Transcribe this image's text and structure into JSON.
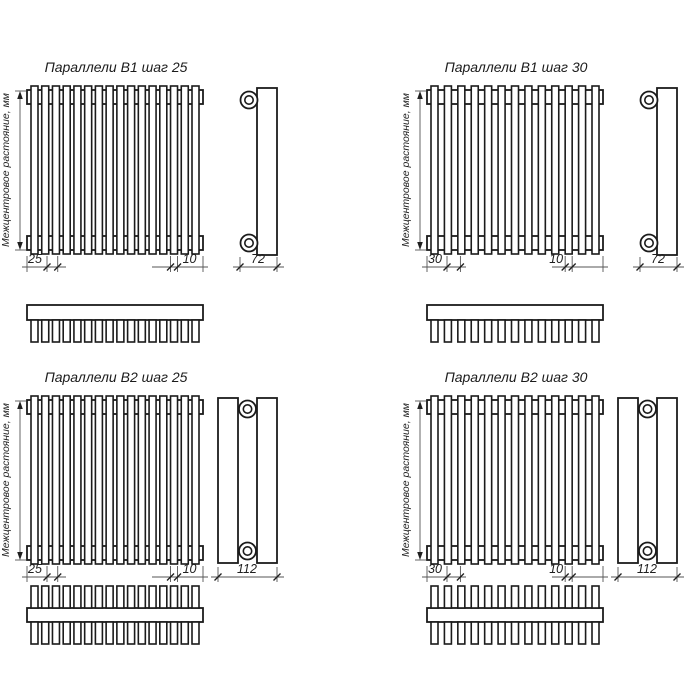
{
  "drawing": {
    "background": "#ffffff",
    "line_color": "#1b1b1b",
    "dim_color": "#555555",
    "text_color": "#1f1f1f",
    "diagrams": [
      {
        "id": "parallels-b1-step-25",
        "title": "Параллели В1 шаг 25",
        "rows": 1,
        "tube_count": 16,
        "step_label": "25",
        "tube_label": "10",
        "depth_label": "72",
        "axis_label": "Межцентровое растояние, мм"
      },
      {
        "id": "parallels-b1-step-30",
        "title": "Параллели В1 шаг 30",
        "rows": 1,
        "tube_count": 13,
        "step_label": "30",
        "tube_label": "10",
        "depth_label": "72",
        "axis_label": "Межцентровое растояние, мм"
      },
      {
        "id": "parallels-b2-step-25",
        "title": "Параллели В2 шаг 25",
        "rows": 2,
        "tube_count": 16,
        "step_label": "25",
        "tube_label": "10",
        "depth_label": "112",
        "axis_label": "Межцентровое растояние, мм"
      },
      {
        "id": "parallels-b2-step-30",
        "title": "Параллели В2 шаг 30",
        "rows": 2,
        "tube_count": 13,
        "step_label": "30",
        "tube_label": "10",
        "depth_label": "112",
        "axis_label": "Межцентровое растояние, мм"
      }
    ]
  }
}
